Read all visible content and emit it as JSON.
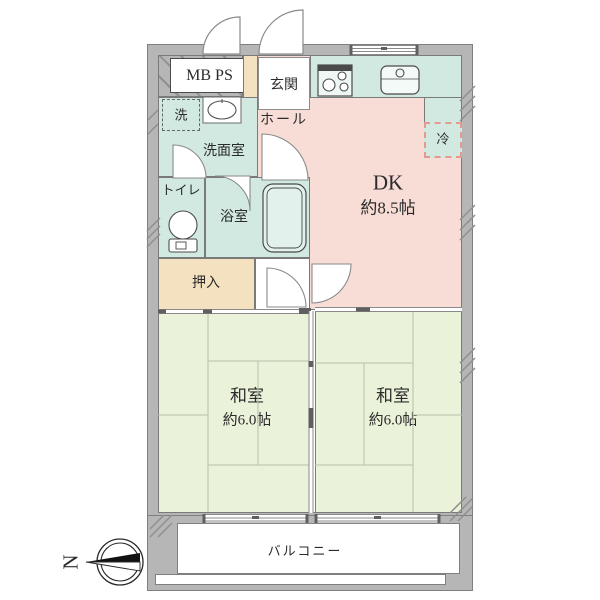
{
  "palette": {
    "wall_gray": "#b6b6b6",
    "wall_line": "#7f7f7f",
    "dk_pink": "#f8dcd6",
    "wet_mint": "#d2e9e2",
    "tatami_green": "#eaf2da",
    "closet_beige": "#f4e1c0",
    "fridge_dash": "#e59a90",
    "tatami_line": "#b7c2a9",
    "text": "#2b2b2b"
  },
  "rooms": {
    "mbps": {
      "label": "MB PS"
    },
    "entrance": {
      "label": "玄関"
    },
    "hall": {
      "label": "ホール"
    },
    "washer": {
      "label": "洗"
    },
    "washroom": {
      "label": "洗面室"
    },
    "toilet": {
      "label": "トイレ"
    },
    "bath": {
      "label": "浴室"
    },
    "closet": {
      "label": "押入"
    },
    "fridge": {
      "label": "冷"
    },
    "dk": {
      "label": "DK",
      "size": "約8.5帖"
    },
    "washitsu_left": {
      "label": "和室",
      "size": "約6.0帖"
    },
    "washitsu_right": {
      "label": "和室",
      "size": "約6.0帖"
    },
    "balcony": {
      "label": "バルコニー"
    }
  },
  "compass": {
    "north": "N"
  }
}
